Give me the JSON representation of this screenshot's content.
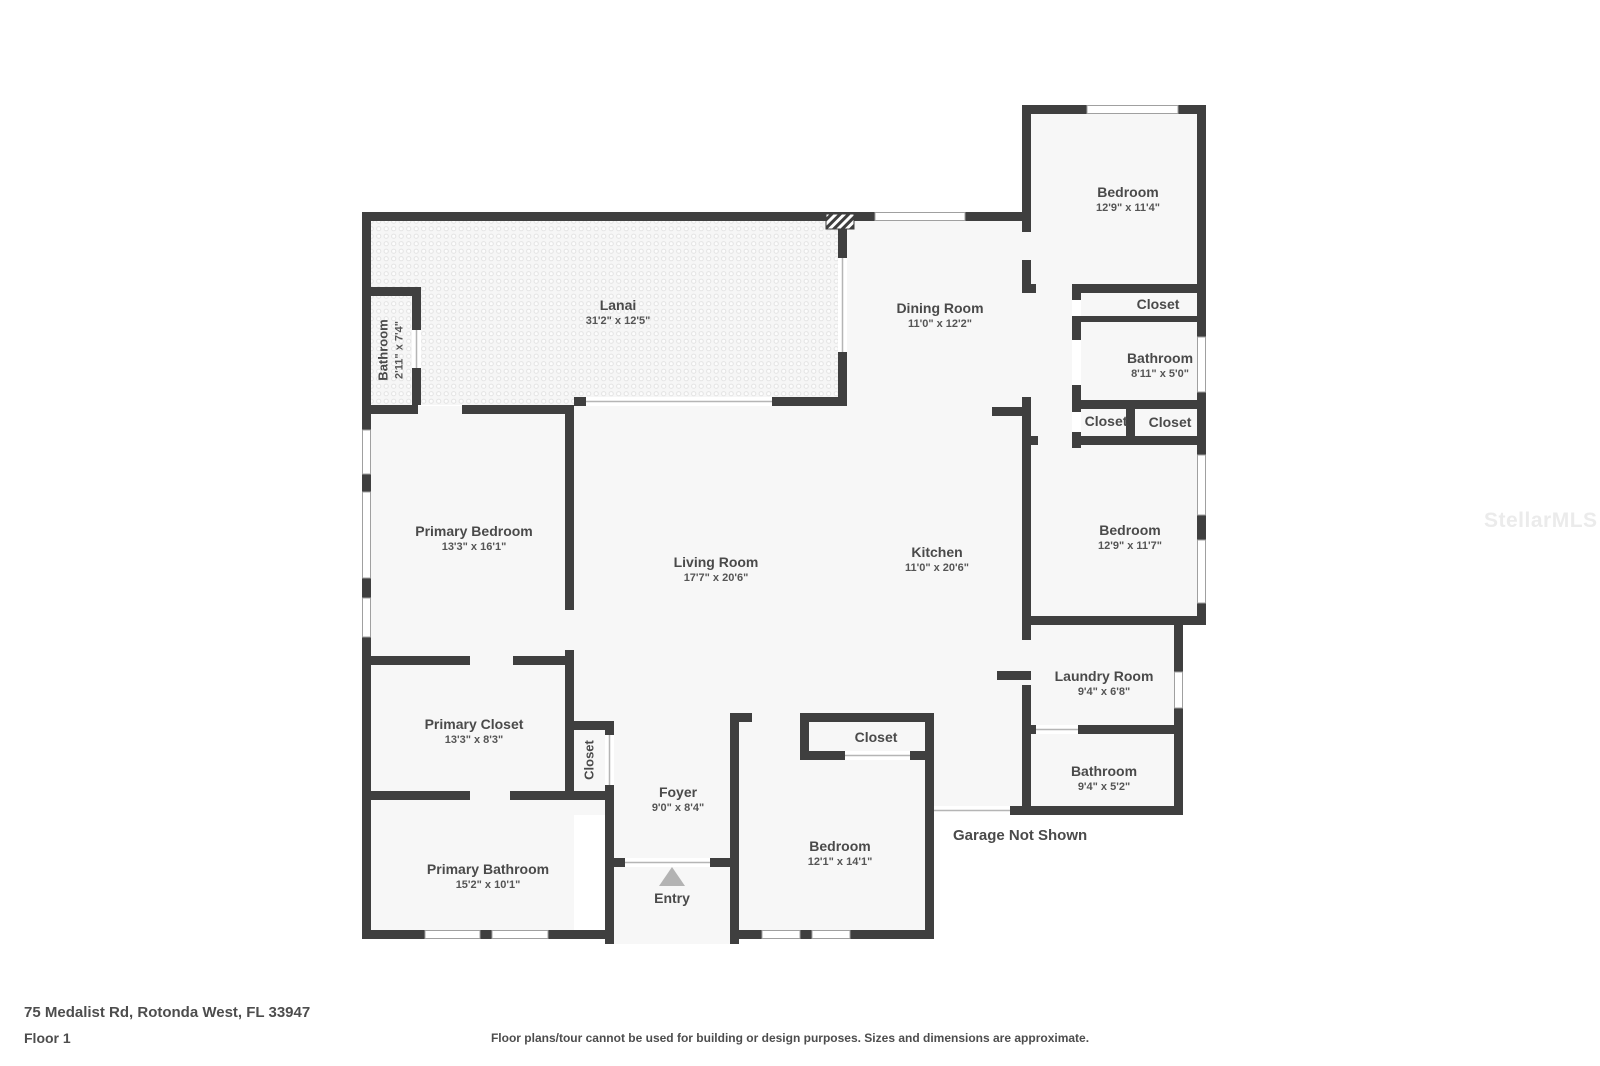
{
  "plan": {
    "address": "75 Medalist Rd, Rotonda West, FL 33947",
    "floor_label": "Floor 1",
    "disclaimer": "Floor plans/tour cannot be used for building or design purposes. Sizes and dimensions are approximate.",
    "watermark": "StellarMLS",
    "garage_note": "Garage Not Shown",
    "entry_label": "Entry",
    "colors": {
      "wall": "#3f3f3f",
      "room_fill": "#f7f7f7",
      "label_text": "#4a4a4a",
      "entry_arrow": "#b3b3b3"
    }
  },
  "rooms": [
    {
      "name": "Lanai",
      "dims": "31'2\" x 12'5\""
    },
    {
      "name": "Bathroom",
      "dims": "2'11\" x 7'4\""
    },
    {
      "name": "Dining Room",
      "dims": "11'0\" x 12'2\""
    },
    {
      "name": "Bedroom",
      "dims": "12'9\" x 11'4\""
    },
    {
      "name": "Closet",
      "dims": ""
    },
    {
      "name": "Bathroom",
      "dims": "8'11\" x 5'0\""
    },
    {
      "name": "Closet",
      "dims": ""
    },
    {
      "name": "Closet",
      "dims": ""
    },
    {
      "name": "Primary Bedroom",
      "dims": "13'3\" x 16'1\""
    },
    {
      "name": "Living Room",
      "dims": "17'7\" x 20'6\""
    },
    {
      "name": "Kitchen",
      "dims": "11'0\" x 20'6\""
    },
    {
      "name": "Bedroom",
      "dims": "12'9\" x 11'7\""
    },
    {
      "name": "Laundry Room",
      "dims": "9'4\" x 6'8\""
    },
    {
      "name": "Bathroom",
      "dims": "9'4\" x 5'2\""
    },
    {
      "name": "Primary Closet",
      "dims": "13'3\" x 8'3\""
    },
    {
      "name": "Closet",
      "dims": ""
    },
    {
      "name": "Foyer",
      "dims": "9'0\" x 8'4\""
    },
    {
      "name": "Primary Bathroom",
      "dims": "15'2\" x 10'1\""
    },
    {
      "name": "Closet",
      "dims": ""
    },
    {
      "name": "Bedroom",
      "dims": "12'1\" x 14'1\""
    }
  ]
}
